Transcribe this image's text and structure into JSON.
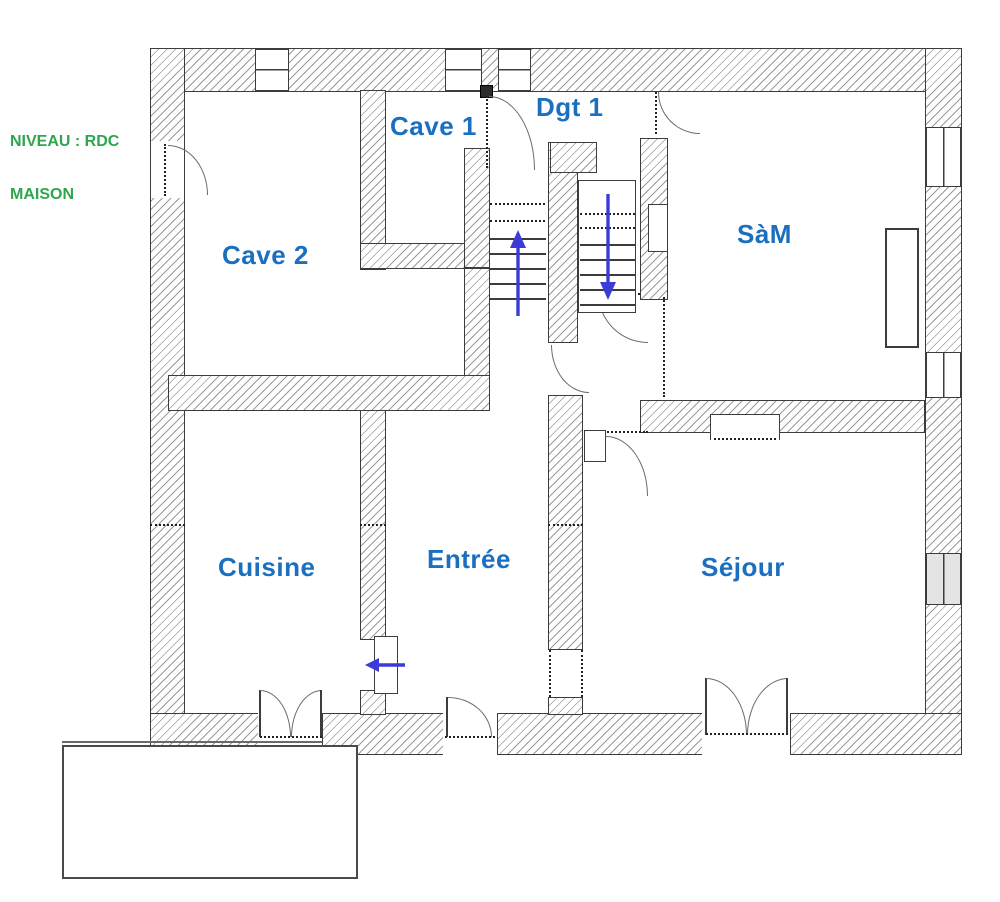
{
  "level_label": {
    "line1": "NIVEAU : RDC",
    "line2": "MAISON"
  },
  "rooms": [
    {
      "name": "cave-2",
      "label": "Cave 2"
    },
    {
      "name": "cave-1",
      "label": "Cave 1"
    },
    {
      "name": "dgt-1",
      "label": "Dgt 1"
    },
    {
      "name": "sam",
      "label": "SàM"
    },
    {
      "name": "cuisine",
      "label": "Cuisine"
    },
    {
      "name": "entree",
      "label": "Entrée"
    },
    {
      "name": "sejour",
      "label": "Séjour"
    }
  ],
  "icons": {
    "stairs_up": "up-arrow",
    "stairs_down": "down-arrow",
    "passage": "left-arrow"
  },
  "colors": {
    "room_label": "#1a6fc0",
    "level_label": "#2EA64E",
    "arrow": "#3b3bd8",
    "wall_line": "#3c3c3c",
    "hatch": "#9a9a9a",
    "window_tint": "#e4e4e4"
  }
}
